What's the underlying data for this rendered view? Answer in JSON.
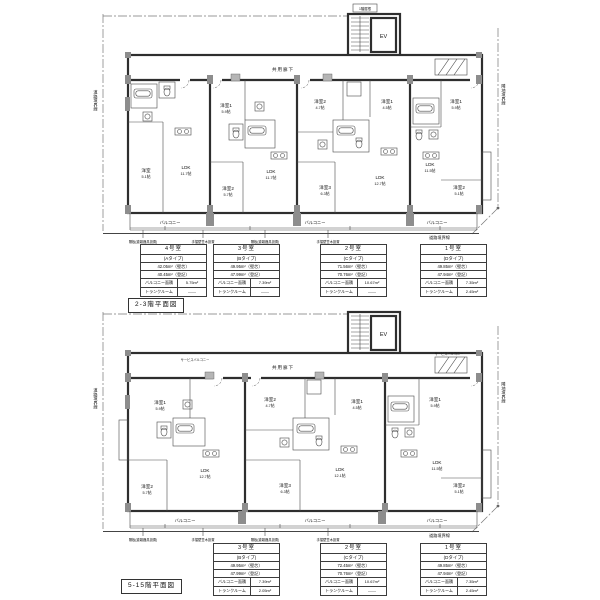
{
  "colors": {
    "ink": "#1a1a1a",
    "wall": "#2e2e2e",
    "column_gray": "#8d8d8d"
  },
  "table_labels": {
    "balcony": "バルコニー面積",
    "trunk": "トランクルーム"
  },
  "plan_upper": {
    "title": "2-3階平面図",
    "corridor": "共用廊下",
    "ev": "EV",
    "roof_note": "1階屋根",
    "boundary_left": "道路境界線",
    "boundary_right": "隣地境界線",
    "boundary_bottom": "道路境界線",
    "balcony1": "バルコニー",
    "balcony2": "バルコニー",
    "balcony3": "バルコニー",
    "note1": "隔板(避難器具設置)",
    "note2": "手摺壁笠木設置",
    "note3": "隔板(避難器具設置)",
    "note4": "手摺壁笠木設置",
    "rooms": [
      {
        "name": "洋室",
        "size": "5.1帖"
      },
      {
        "name": "LDK",
        "size": "11.7帖"
      },
      {
        "name": "洋室1",
        "size": "5.9帖"
      },
      {
        "name": "洋室2",
        "size": "5.7帖"
      },
      {
        "name": "LDK",
        "size": "11.7帖"
      },
      {
        "name": "洋室2",
        "size": "4.7帖"
      },
      {
        "name": "洋室1",
        "size": "4.5帖"
      },
      {
        "name": "洋室3",
        "size": "6.3帖"
      },
      {
        "name": "LDK",
        "size": "12.7帖"
      },
      {
        "name": "洋室1",
        "size": "5.9帖"
      },
      {
        "name": "洋室2",
        "size": "5.1帖"
      },
      {
        "name": "LDK",
        "size": "11.5帖"
      }
    ]
  },
  "plan_lower": {
    "title": "5-15階平面図",
    "corridor": "共用廊下",
    "ev": "EV",
    "service_left": "サービスバルコニー",
    "service_right": "サービスバルコニー",
    "boundary_left": "道路境界線",
    "boundary_right": "隣地境界線",
    "boundary_bottom": "道路境界線",
    "balcony1": "バルコニー",
    "balcony2": "バルコニー",
    "balcony3": "バルコニー",
    "note1": "隔板(避難器具設置)",
    "note2": "手摺壁笠木設置",
    "note3": "隔板(避難器具設置)",
    "note4": "手摺壁笠木設置",
    "rooms": [
      {
        "name": "洋室1",
        "size": "5.9帖"
      },
      {
        "name": "洋室2",
        "size": "5.7帖"
      },
      {
        "name": "LDK",
        "size": "12.7帖"
      },
      {
        "name": "洋室2",
        "size": "4.7帖"
      },
      {
        "name": "洋室1",
        "size": "4.5帖"
      },
      {
        "name": "洋室3",
        "size": "6.3帖"
      },
      {
        "name": "LDK",
        "size": "12.1帖"
      },
      {
        "name": "洋室1",
        "size": "5.9帖"
      },
      {
        "name": "洋室2",
        "size": "5.1帖"
      },
      {
        "name": "LDK",
        "size": "11.5帖"
      }
    ]
  },
  "tables_upper": [
    {
      "room": "4号室",
      "type": "(Aタイプ)",
      "area_wall": "42.05m²（壁芯）",
      "area_reg": "40.45m²（登記）",
      "balcony": "5.75m²",
      "trunk": "——"
    },
    {
      "room": "3号室",
      "type": "(Bタイプ)",
      "area_wall": "49.95m²（壁芯）",
      "area_reg": "47.99m²（登記）",
      "balcony": "7.39m²",
      "trunk": "——"
    },
    {
      "room": "2号室",
      "type": "(Cタイプ)",
      "area_wall": "71.56m²（壁芯）",
      "area_reg": "70.76m²（登記）",
      "balcony": "10.67m²",
      "trunk": "——"
    },
    {
      "room": "1号室",
      "type": "(Dタイプ)",
      "area_wall": "49.85m²（壁芯）",
      "area_reg": "47.94m²（登記）",
      "balcony": "7.35m²",
      "trunk": "2.45m²"
    }
  ],
  "tables_lower": [
    {
      "room": "3号室",
      "type": "(Bタイプ)",
      "area_wall": "49.95m²（壁芯）",
      "area_reg": "47.99m²（登記）",
      "balcony": "7.39m²",
      "trunk": "2.05m²"
    },
    {
      "room": "2号室",
      "type": "(Cタイプ)",
      "area_wall": "72.45m²（壁芯）",
      "area_reg": "70.76m²（登記）",
      "balcony": "10.67m²",
      "trunk": "——"
    },
    {
      "room": "1号室",
      "type": "(Dタイプ)",
      "area_wall": "49.85m²（壁芯）",
      "area_reg": "47.94m²（登記）",
      "balcony": "7.35m²",
      "trunk": "2.45m²"
    }
  ]
}
